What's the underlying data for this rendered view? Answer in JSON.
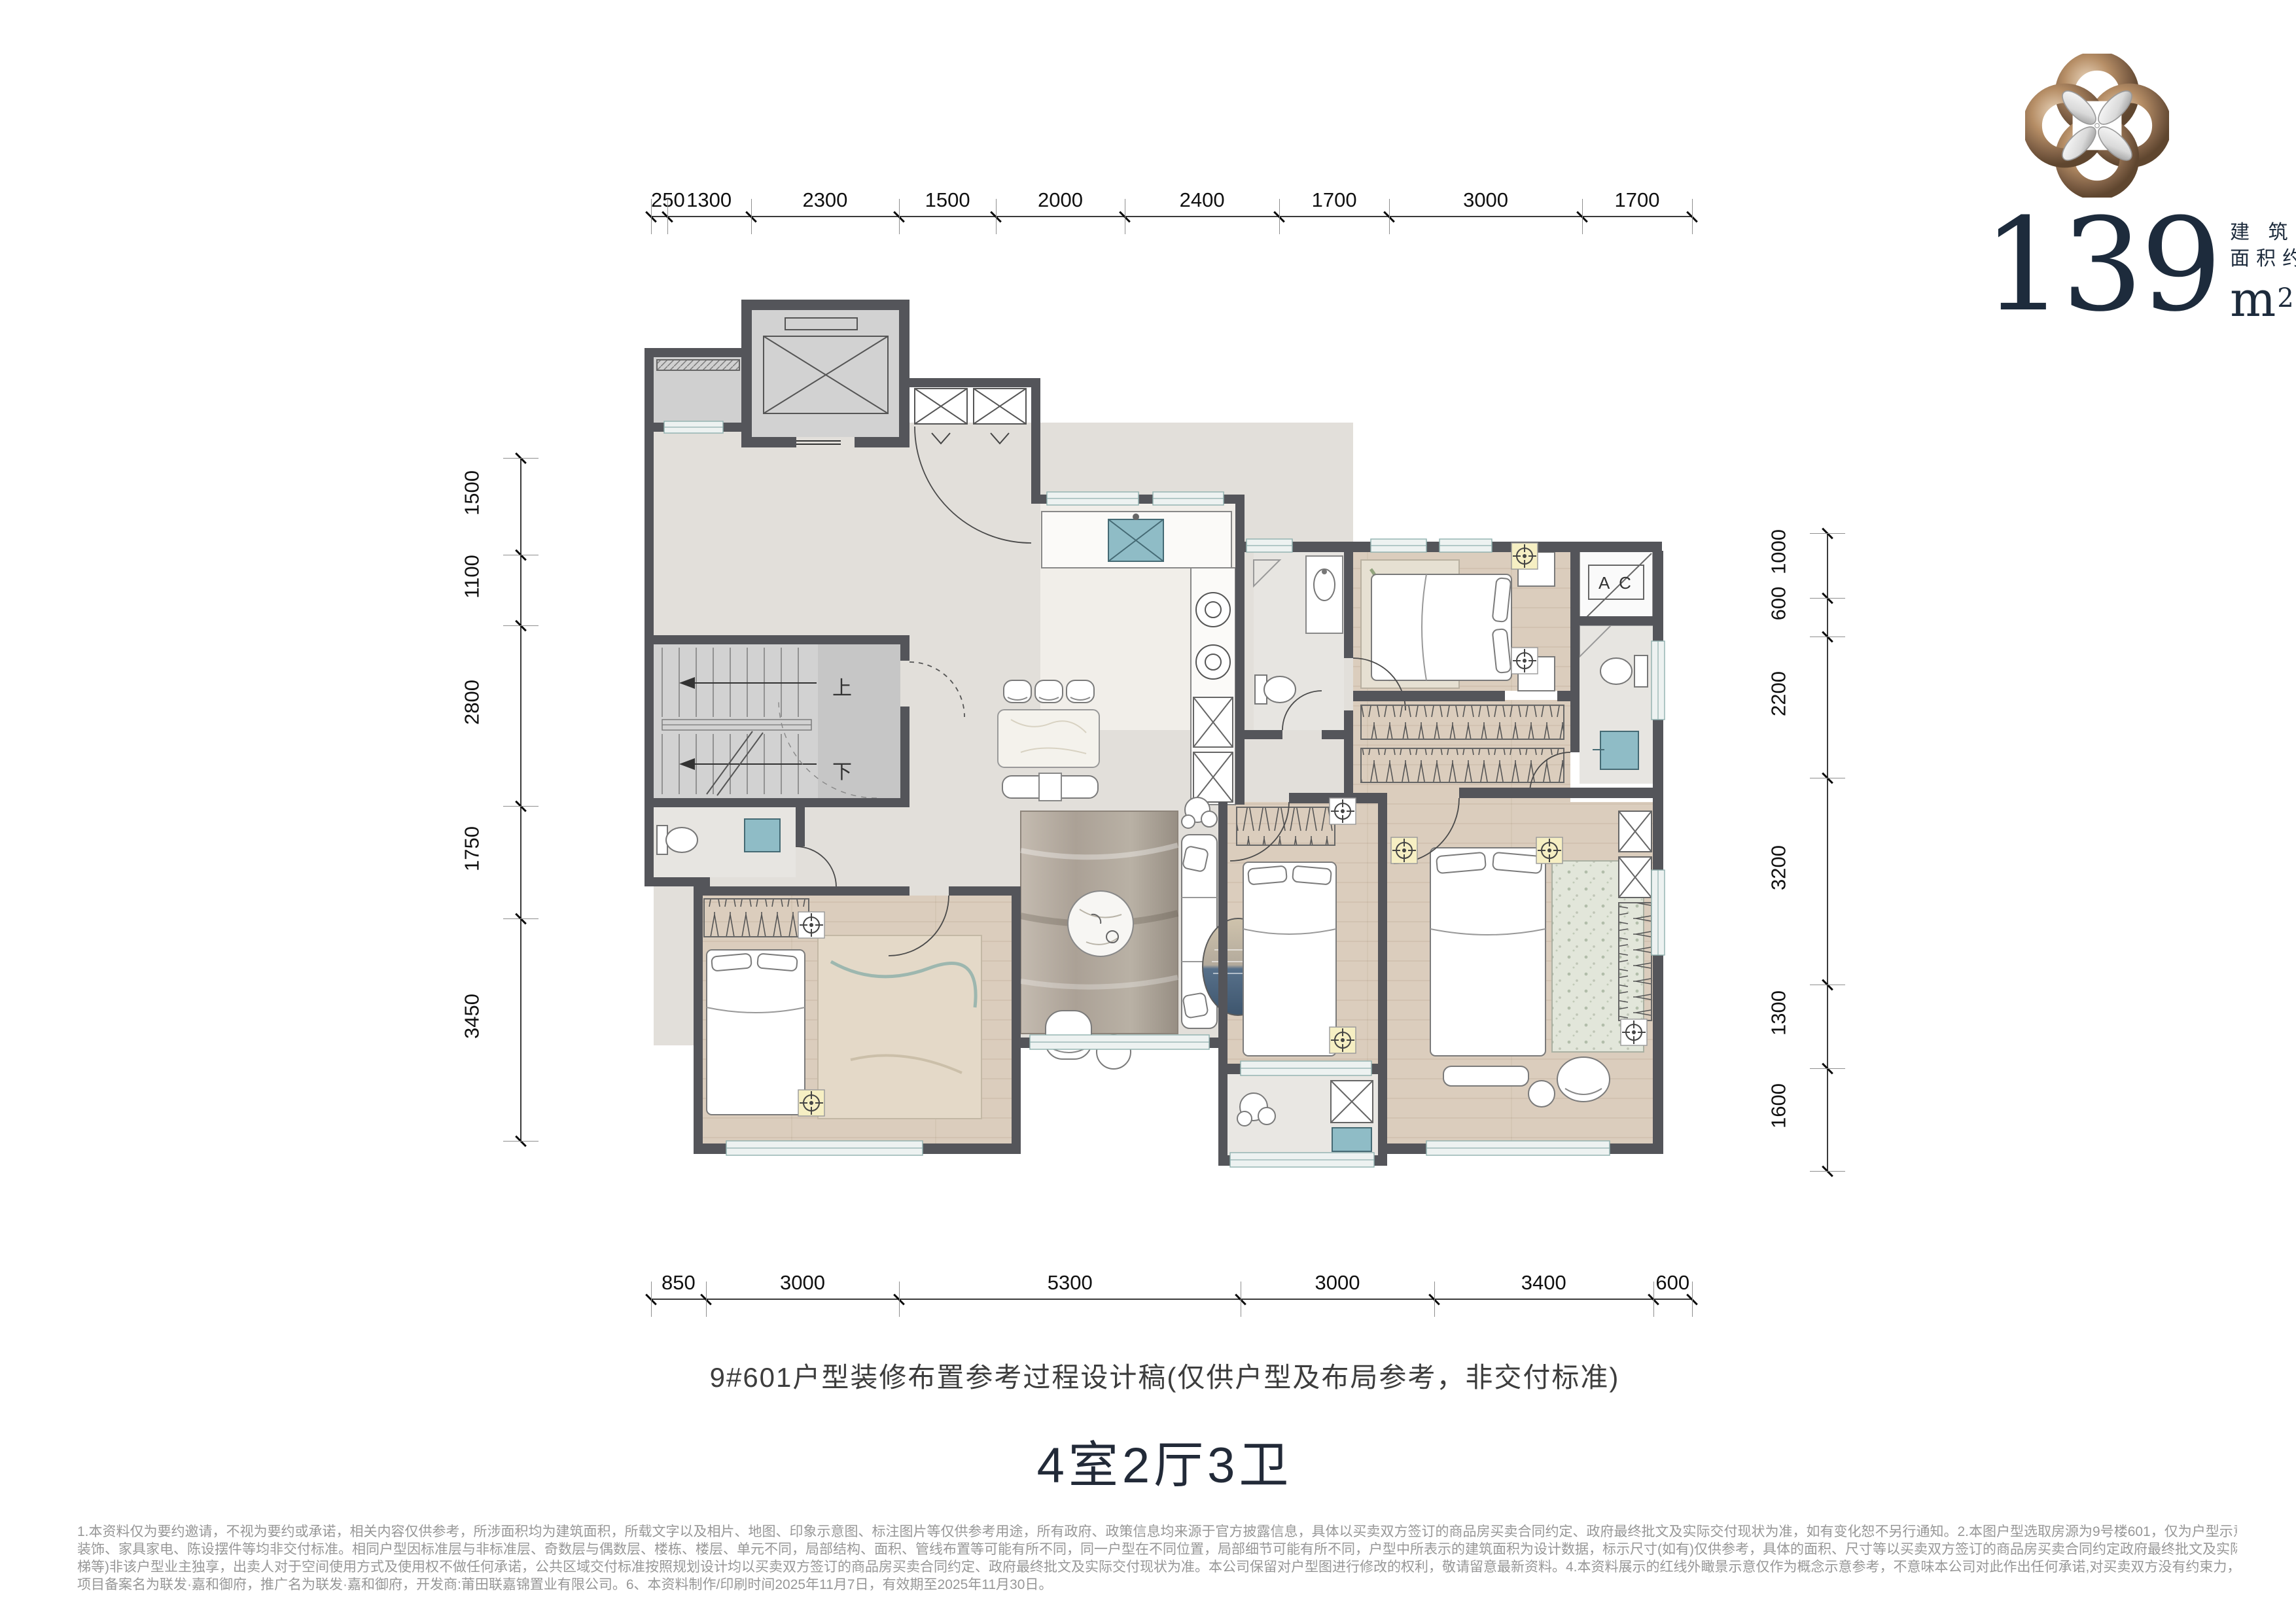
{
  "logo": {
    "area_number": "139",
    "area_unit_base": "m",
    "area_unit_exponent": "2",
    "area_label_line1": "建 筑",
    "area_label_line2": "面积约"
  },
  "plan_labels": {
    "stairs_up": "上",
    "stairs_down": "下",
    "ac_unit": "A C"
  },
  "dimensions": {
    "top": [
      "250",
      "1300",
      "2300",
      "1500",
      "2000",
      "2400",
      "1700",
      "3000",
      "1700"
    ],
    "bottom": [
      "850",
      "3000",
      "5300",
      "3000",
      "3400",
      "600"
    ],
    "left": [
      "1500",
      "1100",
      "2800",
      "1750",
      "3450"
    ],
    "right": [
      "1000",
      "600",
      "2200",
      "3200",
      "1300",
      "1600"
    ]
  },
  "caption": "9#601户型装修布置参考过程设计稿(仅供户型及布局参考，非交付标准)",
  "unit_title": "4室2厅3卫",
  "disclaimer_lines": [
    "1.本资料仅为要约邀请，不视为要约或承诺，相关内容仅供参考，所涉面积均为建筑面积，所载文字以及相片、地图、印象示意图、标注图片等仅供参考用途，所有政府、政策信息均来源于官方披露信息，具体以买卖双方签订的商品房买卖合同约定、政府最终批文及实际交付现状为准，如有变化恕不另行通知。2.本图户型选取房源为9号楼601，仅为户型示意、功能创意展示和装修意境创想展示，仅供购房参考，不属于交付内容和交付标准，装修",
    "装饰、家具家电、陈设摆件等均非交付标准。相同户型因标准层与非标准层、奇数层与偶数层、楼栋、楼层、单元不同，局部结构、面积、管线布置等可能有所不同，同一户型在不同位置，局部细节可能有所不同，户型中所表示的建筑面积为设计数据，标示尺寸(如有)仅供参考，具体的面积、尺寸等以买卖双方签订的商品房买卖合同约定政府最终批文及实际交付现状为准。3.部分户型单元展示的公共区域位置及结构(例如:电梯、消防前室、消防楼",
    "梯等)非该户型业主独享，出卖人对于空间使用方式及使用权不做任何承诺，公共区域交付标准按照规划设计均以买卖双方签订的商品房买卖合同约定、政府最终批文及实际交付现状为准。本公司保留对户型图进行修改的权利，敬请留意最新资料。4.本资料展示的红线外瞰景示意仅作为概念示意参考，不意味本公司对此作出任何承诺,对买卖双方没有约束力，为了避免误解，建议客户自行前往项目实体现场了解距离关系及周边建筑物情况。5.本",
    "项目备案名为联发·嘉和御府，推广名为联发·嘉和御府，开发商:莆田联嘉锦置业有限公司。6、本资料制作/印刷时间2025年11月7日，有效期至2025年11月30日。"
  ],
  "colors": {
    "wall": "#54555a",
    "tile_floor": "#e2dfda",
    "wood_floor": "#dbcdbd",
    "bath_floor": "#e7e5e1",
    "accent_teal": "#8fbcc6",
    "window_band": "#edf2f1",
    "logo_bronze": "#a9835f",
    "logo_navy": "#1d2b3c"
  }
}
